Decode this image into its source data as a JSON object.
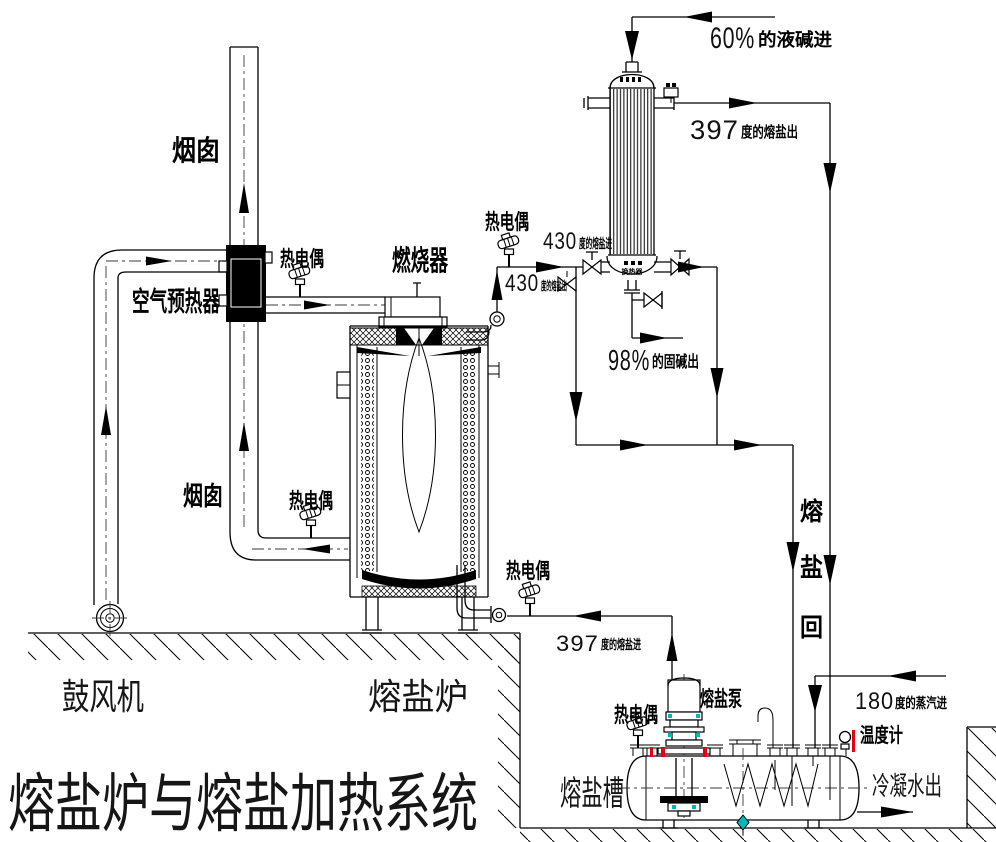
{
  "title": "熔盐炉与熔盐加热系统",
  "labels": {
    "chimney_top": "烟囱",
    "chimney_duct": "烟囱",
    "air_preheater": "空气预热器",
    "burner": "燃烧器",
    "blower": "鼓风机",
    "furnace": "熔盐炉",
    "thermocouple": "热电偶",
    "pump": "熔盐泵",
    "tank": "熔盐槽",
    "thermometer": "温度计",
    "exchanger_tag": "换热器"
  },
  "streams": {
    "caustic_in": {
      "num": "60%",
      "text": "的液碱进"
    },
    "salt_out_397": {
      "num": "397",
      "text": "度的熔盐出"
    },
    "salt_in_430": {
      "num": "430",
      "text": "度的熔盐进"
    },
    "salt_out_430": {
      "num": "430",
      "text": "度的熔盐出"
    },
    "caustic_out": {
      "num": "98%",
      "text": "的固碱出"
    },
    "salt_in_397": {
      "num": "397",
      "text": "度的熔盐进"
    },
    "steam_in": {
      "num": "180",
      "text": "度的蒸汽进"
    },
    "condensate_out": "冷凝水出",
    "salt_return": {
      "c1": "熔",
      "c2": "盐",
      "c3": "回"
    }
  },
  "colors": {
    "line": "#000000",
    "red": "#e60012",
    "cyan": "#00b7bd"
  }
}
